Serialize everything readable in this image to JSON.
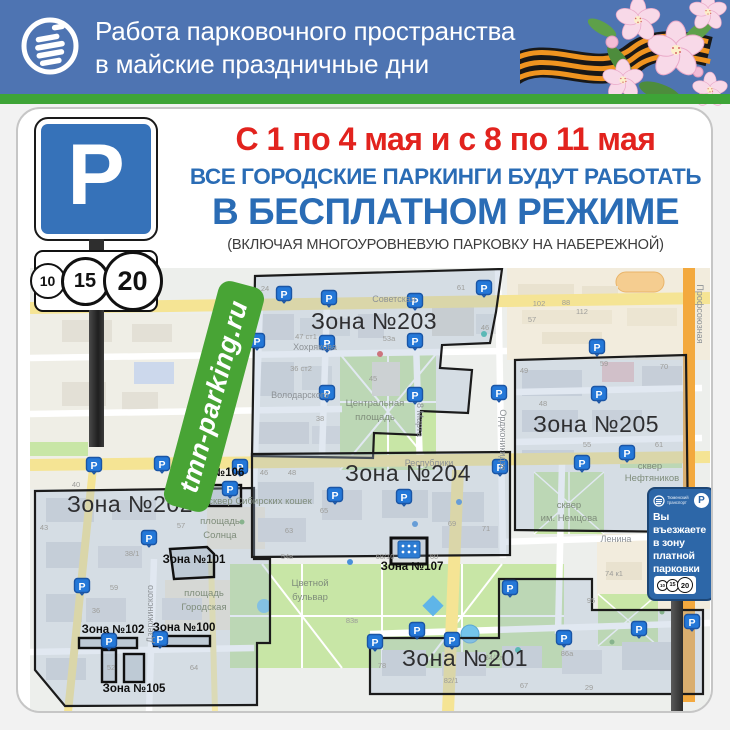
{
  "header": {
    "title_line1": "Работа парковочного пространства",
    "title_line2": "в майские праздничные дни"
  },
  "title": {
    "dates": "С 1 по 4 мая и с 8 по 11 мая",
    "line1": "ВСЕ ГОРОДСКИЕ ПАРКИНГИ БУДУТ РАБОТАТЬ",
    "line2": "В БЕСПЛАТНОМ РЕЖИМЕ",
    "note": "(ВКЛЮЧАЯ МНОГОУРОВНЕВУЮ ПАРКОВКУ НА НАБЕРЕЖНОЙ)"
  },
  "parking_sign": {
    "letter": "P",
    "tariffs": [
      "10",
      "15",
      "20"
    ]
  },
  "site_label": "tmn-parking.ru",
  "entrance_sign": {
    "operator_line1": "Тюменский",
    "operator_line2": "транспорт",
    "letter": "P",
    "text_lines": [
      "Вы",
      "въезжаете",
      "в зону",
      "платной",
      "парковки"
    ],
    "tariffs": [
      "10",
      "15",
      "20"
    ]
  },
  "map": {
    "marker_letter": "P",
    "markers": [
      {
        "x": 282,
        "y": 293
      },
      {
        "x": 327,
        "y": 297
      },
      {
        "x": 413,
        "y": 300
      },
      {
        "x": 482,
        "y": 287
      },
      {
        "x": 232,
        "y": 342
      },
      {
        "x": 255,
        "y": 340
      },
      {
        "x": 325,
        "y": 342
      },
      {
        "x": 413,
        "y": 340
      },
      {
        "x": 325,
        "y": 392
      },
      {
        "x": 413,
        "y": 394
      },
      {
        "x": 497,
        "y": 392
      },
      {
        "x": 595,
        "y": 346
      },
      {
        "x": 597,
        "y": 393
      },
      {
        "x": 498,
        "y": 466
      },
      {
        "x": 580,
        "y": 462
      },
      {
        "x": 625,
        "y": 452
      },
      {
        "x": 238,
        "y": 466
      },
      {
        "x": 333,
        "y": 494
      },
      {
        "x": 402,
        "y": 496
      },
      {
        "x": 92,
        "y": 464
      },
      {
        "x": 160,
        "y": 463
      },
      {
        "x": 228,
        "y": 488
      },
      {
        "x": 147,
        "y": 537
      },
      {
        "x": 80,
        "y": 585
      },
      {
        "x": 107,
        "y": 640
      },
      {
        "x": 158,
        "y": 638
      },
      {
        "x": 373,
        "y": 641
      },
      {
        "x": 415,
        "y": 629
      },
      {
        "x": 450,
        "y": 639
      },
      {
        "x": 508,
        "y": 587
      },
      {
        "x": 562,
        "y": 637
      },
      {
        "x": 637,
        "y": 628
      },
      {
        "x": 690,
        "y": 621
      }
    ],
    "zone_labels_large": [
      {
        "t": "Зона №203",
        "x": 372,
        "y": 327
      },
      {
        "t": "Зона №205",
        "x": 594,
        "y": 430
      },
      {
        "t": "Зона №202",
        "x": 128,
        "y": 510
      },
      {
        "t": "Зона №204",
        "x": 406,
        "y": 479
      },
      {
        "t": "Зона №201",
        "x": 463,
        "y": 664
      }
    ],
    "zone_labels_small": [
      {
        "t": "Зона №106",
        "x": 211,
        "y": 474
      },
      {
        "t": "Зона №101",
        "x": 192,
        "y": 561
      },
      {
        "t": "Зона №107",
        "x": 410,
        "y": 568
      },
      {
        "t": "Зона №102",
        "x": 111,
        "y": 631
      },
      {
        "t": "Зона №100",
        "x": 182,
        "y": 629
      },
      {
        "t": "Зона №105",
        "x": 132,
        "y": 690
      }
    ],
    "street_labels": [
      {
        "t": "Советская",
        "x": 392,
        "y": 300,
        "r": 0
      },
      {
        "t": "Хохрякова",
        "x": 313,
        "y": 348,
        "r": 0
      },
      {
        "t": "Володарского",
        "x": 298,
        "y": 396,
        "r": 0
      },
      {
        "t": "Республики",
        "x": 427,
        "y": 464,
        "r": 0
      },
      {
        "t": "Ленина",
        "x": 614,
        "y": 540,
        "r": 0
      },
      {
        "t": "8 Марта",
        "x": 415,
        "y": 418,
        "r": 90
      },
      {
        "t": "Орджоникидзе",
        "x": 498,
        "y": 438,
        "r": 90
      },
      {
        "t": "Дзержинского",
        "x": 151,
        "y": 612,
        "r": -90
      },
      {
        "t": "Профсоюзная",
        "x": 695,
        "y": 312,
        "r": 90
      }
    ],
    "place_labels": [
      {
        "t": "Центральная",
        "x": 373,
        "y": 404
      },
      {
        "t": "площадь",
        "x": 373,
        "y": 418
      },
      {
        "t": "Цветной",
        "x": 308,
        "y": 584
      },
      {
        "t": "бульвар",
        "x": 308,
        "y": 598
      },
      {
        "t": "сквер",
        "x": 567,
        "y": 506
      },
      {
        "t": "им. Немцова",
        "x": 567,
        "y": 519
      },
      {
        "t": "сквер",
        "x": 648,
        "y": 467
      },
      {
        "t": "Нефтяников",
        "x": 650,
        "y": 479
      },
      {
        "t": "площадь",
        "x": 218,
        "y": 522
      },
      {
        "t": "Солнца",
        "x": 218,
        "y": 536
      },
      {
        "t": "площадь",
        "x": 202,
        "y": 594
      },
      {
        "t": "Городская",
        "x": 202,
        "y": 608
      },
      {
        "t": "сквер Сибирских кошек",
        "x": 258,
        "y": 502
      }
    ],
    "house_numbers": [
      {
        "t": "24",
        "x": 263,
        "y": 289
      },
      {
        "t": "61",
        "x": 459,
        "y": 288
      },
      {
        "t": "47 ст1",
        "x": 304,
        "y": 337
      },
      {
        "t": "53а",
        "x": 387,
        "y": 339
      },
      {
        "t": "46",
        "x": 483,
        "y": 328
      },
      {
        "t": "36 ст2",
        "x": 299,
        "y": 369
      },
      {
        "t": "45",
        "x": 371,
        "y": 379
      },
      {
        "t": "38",
        "x": 318,
        "y": 419
      },
      {
        "t": "102",
        "x": 537,
        "y": 304
      },
      {
        "t": "88",
        "x": 564,
        "y": 303
      },
      {
        "t": "112",
        "x": 580,
        "y": 312
      },
      {
        "t": "57",
        "x": 530,
        "y": 320
      },
      {
        "t": "49",
        "x": 522,
        "y": 371
      },
      {
        "t": "59",
        "x": 602,
        "y": 364
      },
      {
        "t": "70",
        "x": 662,
        "y": 367
      },
      {
        "t": "48",
        "x": 541,
        "y": 404
      },
      {
        "t": "55",
        "x": 585,
        "y": 445
      },
      {
        "t": "61",
        "x": 657,
        "y": 445
      },
      {
        "t": "40",
        "x": 74,
        "y": 485
      },
      {
        "t": "43",
        "x": 42,
        "y": 528
      },
      {
        "t": "57",
        "x": 179,
        "y": 526
      },
      {
        "t": "38/1",
        "x": 130,
        "y": 554
      },
      {
        "t": "59",
        "x": 112,
        "y": 588
      },
      {
        "t": "36",
        "x": 94,
        "y": 611
      },
      {
        "t": "52",
        "x": 109,
        "y": 668
      },
      {
        "t": "64",
        "x": 192,
        "y": 668
      },
      {
        "t": "46",
        "x": 262,
        "y": 473
      },
      {
        "t": "48",
        "x": 290,
        "y": 473
      },
      {
        "t": "65",
        "x": 322,
        "y": 511
      },
      {
        "t": "63",
        "x": 287,
        "y": 531
      },
      {
        "t": "69",
        "x": 450,
        "y": 524
      },
      {
        "t": "71",
        "x": 484,
        "y": 529
      },
      {
        "t": "54в",
        "x": 285,
        "y": 557
      },
      {
        "t": "68/10",
        "x": 383,
        "y": 557
      },
      {
        "t": "60",
        "x": 432,
        "y": 557
      },
      {
        "t": "83в",
        "x": 350,
        "y": 621
      },
      {
        "t": "95",
        "x": 589,
        "y": 601
      },
      {
        "t": "78",
        "x": 380,
        "y": 666
      },
      {
        "t": "82/1",
        "x": 449,
        "y": 681
      },
      {
        "t": "84/2а",
        "x": 492,
        "y": 658
      },
      {
        "t": "86а",
        "x": 565,
        "y": 654
      },
      {
        "t": "67",
        "x": 522,
        "y": 686
      },
      {
        "t": "29",
        "x": 587,
        "y": 688
      },
      {
        "t": "74 к1",
        "x": 612,
        "y": 574
      }
    ]
  }
}
